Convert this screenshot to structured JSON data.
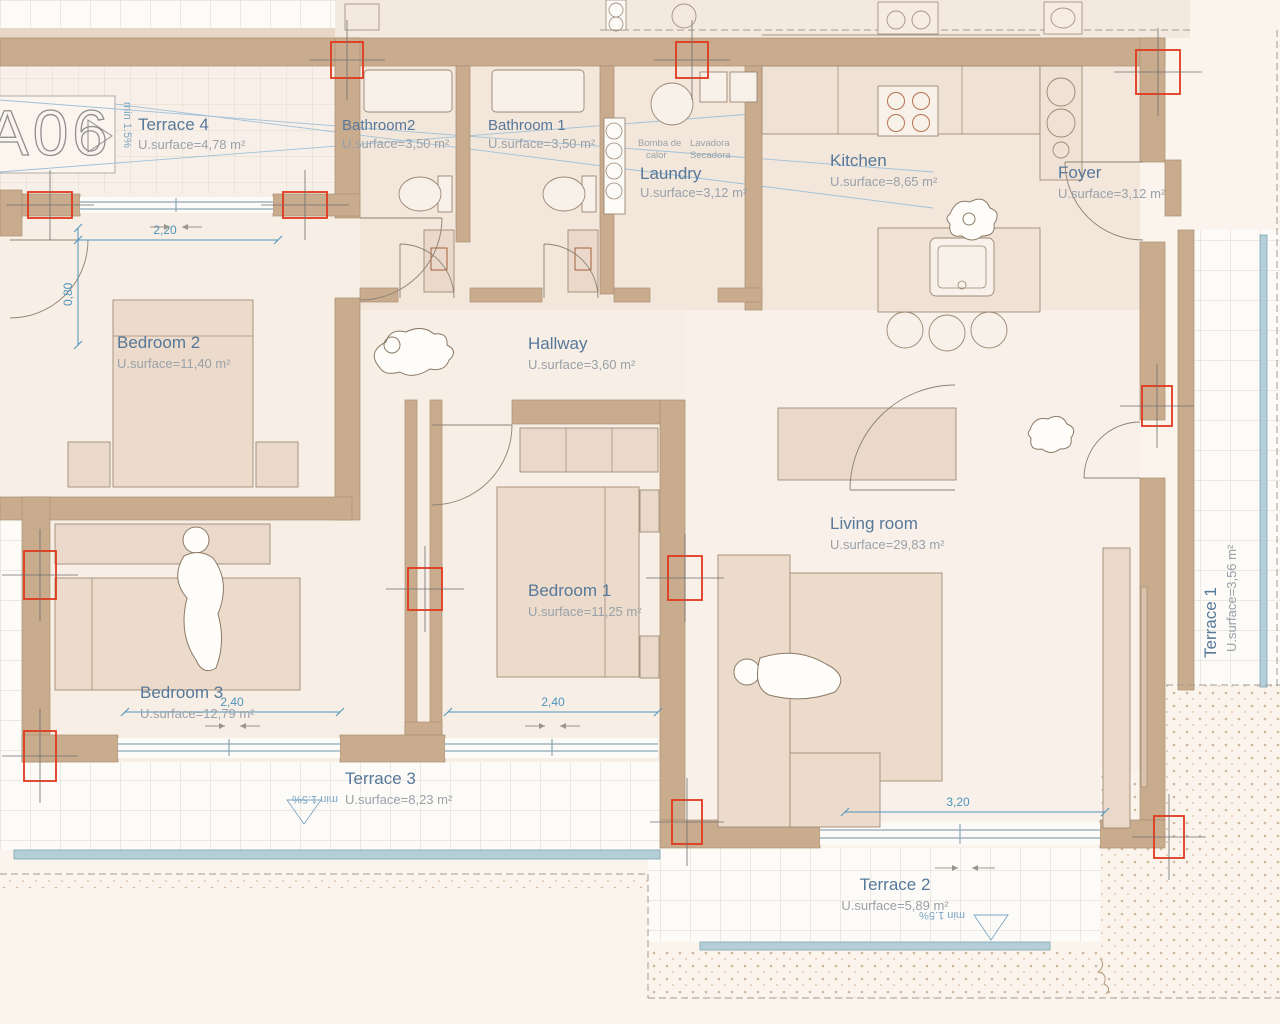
{
  "annotations": {
    "unit": "A06",
    "slope": "min 1.5%",
    "heat_pump_line1": "Bomba de",
    "heat_pump_line2": "calor",
    "washer": "Lavadora",
    "dryer": "Secadora"
  },
  "rooms": [
    {
      "name": "Terrace 4",
      "area": "U.surface=4,78 m²"
    },
    {
      "name": "Bathroom2",
      "area": "U.surface=3,50 m²"
    },
    {
      "name": "Bathroom 1",
      "area": "U.surface=3,50 m²"
    },
    {
      "name": "Laundry",
      "area": "U.surface=3,12 m²"
    },
    {
      "name": "Kitchen",
      "area": "U.surface=8,65 m²"
    },
    {
      "name": "Foyer",
      "area": "U.surface=3,12 m²"
    },
    {
      "name": "Bedroom 2",
      "area": "U.surface=11,40 m²"
    },
    {
      "name": "Hallway",
      "area": "U.surface=3,60 m²"
    },
    {
      "name": "Bedroom 1",
      "area": "U.surface=11,25 m²"
    },
    {
      "name": "Bedroom 3",
      "area": "U.surface=12,79 m²"
    },
    {
      "name": "Living room",
      "area": "U.surface=29,83 m²"
    },
    {
      "name": "Terrace 3",
      "area": "U.surface=8,23 m²"
    },
    {
      "name": "Terrace 2",
      "area": "U.surface=5,89 m²"
    },
    {
      "name": "Terrace 1",
      "area": "U.surface=3,56 m²"
    }
  ],
  "dimensions": {
    "bedroom2_window": "2,20",
    "bedroom2_door": "0,80",
    "bedroom3_window": "2,40",
    "bedroom1_window": "2,40",
    "living_window": "3,20"
  },
  "colors": {
    "wall": "#c9ab8e",
    "column_marker": "#e0391d",
    "dimension": "#4e94bd",
    "room_label": "#56789a",
    "area_label": "#99a1a9",
    "balustrade": "#b5cfd9",
    "background": "#faf4ec"
  }
}
